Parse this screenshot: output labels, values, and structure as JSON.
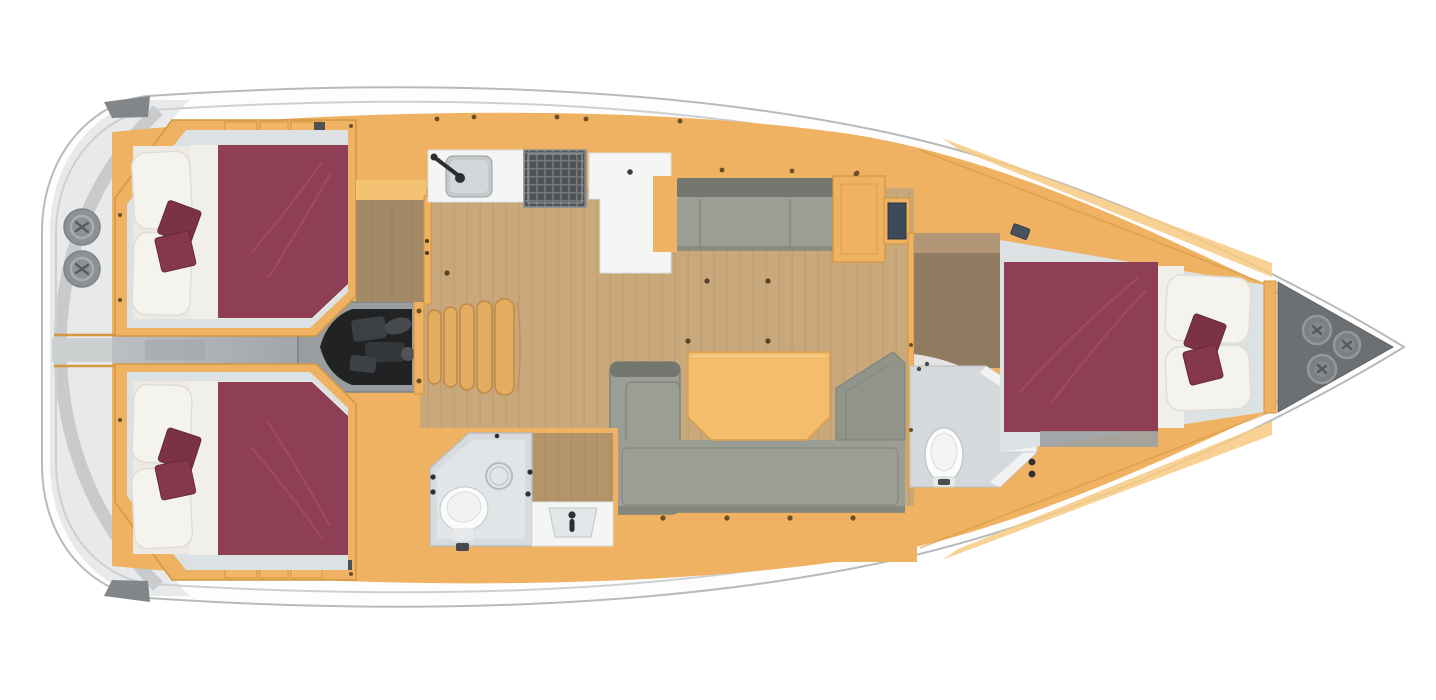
{
  "figure": {
    "type": "yacht-interior-floorplan",
    "view": "top-down",
    "orientation": "bow-right-stern-left",
    "visible_text": []
  },
  "palette": {
    "hull_fill": "#fdfdfe",
    "hull_stroke": "#b7babc",
    "deck_line": "#cdd0d2",
    "transom_shade": "#e7e9ea",
    "transom_arc": "#c4c7c9",
    "corner_cap": "#828688",
    "winch": "#8e9193",
    "winch_ring": "#aaadaf",
    "winch_mark": "#565a5c",
    "orange": "#efb262",
    "orange_light": "#f7ca82",
    "orange_line": "#d2973f",
    "table": "#f3bd6c",
    "table_line": "#d79e50",
    "wood": "#c9a87c",
    "wood_line": "#b9986d",
    "door_brown": "#a28a69",
    "passage_brown": "#8f7c60",
    "passage_light": "#b29776",
    "maroon": "#8e3e55",
    "maroon_line": "#a34f68",
    "cushion": "#7c3245",
    "cushion2": "#85374c",
    "pillow": "#f4f3ee",
    "pillow_line": "#dfddd4",
    "sheet": "#f0efe9",
    "bed_base": "#eceae3",
    "cabin_floor": "#dce1e4",
    "sofa": "#9b9e95",
    "sofa_dark": "#74776f",
    "sofa_line": "#84877e",
    "counter_white": "#f4f5f5",
    "counter_line": "#dcdee0",
    "sink": "#c6c9cb",
    "sink_inner": "#d4d7d9",
    "stove": "#505456",
    "stove_grid": "#73767a",
    "head_room": "#d6d9db",
    "head_white": "#f1f2f3",
    "corridor": "#bcbfc1",
    "corridor_dark": "#a2a5a7",
    "engine_frame": "#999da0",
    "engine_dark": "#202224",
    "engine_mid": "#3c4043",
    "navy_locker": "#3d4a58",
    "hatch_blue": "#46525e",
    "step": "#e3ac60",
    "step_line": "#c08a45",
    "bow_dark": "#6d7073",
    "bow_circle": "#7d8082",
    "bow_ring": "#95989a",
    "fixture_dark": "#2c2e30",
    "screw": "#6b4e26"
  },
  "areas": [
    {
      "id": "stern-swim-platform",
      "features": [
        "winch",
        "winch",
        "transom-arc"
      ]
    },
    {
      "id": "aft-cabin-port",
      "features": [
        "double-berth",
        "two-pillows",
        "two-cushions",
        "shelf-lockers"
      ]
    },
    {
      "id": "aft-cabin-starboard",
      "features": [
        "double-berth",
        "two-pillows",
        "two-cushions",
        "shelf-lockers"
      ]
    },
    {
      "id": "engine-compartment",
      "features": [
        "engine-block"
      ]
    },
    {
      "id": "companionway-steps",
      "step_count": 5
    },
    {
      "id": "galley-port",
      "features": [
        "sink-with-faucet",
        "stove-grill",
        "l-shaped-counter-fridge"
      ]
    },
    {
      "id": "salon",
      "features": [
        "port-settee",
        "u-shaped-sofa",
        "dining-table",
        "wood-floor"
      ]
    },
    {
      "id": "aft-head-starboard",
      "features": [
        "toilet",
        "shower-drain",
        "washbasin"
      ]
    },
    {
      "id": "forward-head-starboard",
      "features": [
        "toilet",
        "vanity-unit"
      ]
    },
    {
      "id": "wardrobe-passage-port",
      "features": [
        "door-swing"
      ]
    },
    {
      "id": "forward-cabin",
      "features": [
        "double-berth",
        "two-pillows",
        "two-cushions",
        "hull-hatch"
      ]
    },
    {
      "id": "anchor-locker-bow",
      "features": [
        "deck-hatch",
        "deck-hatch",
        "deck-hatch"
      ]
    }
  ]
}
